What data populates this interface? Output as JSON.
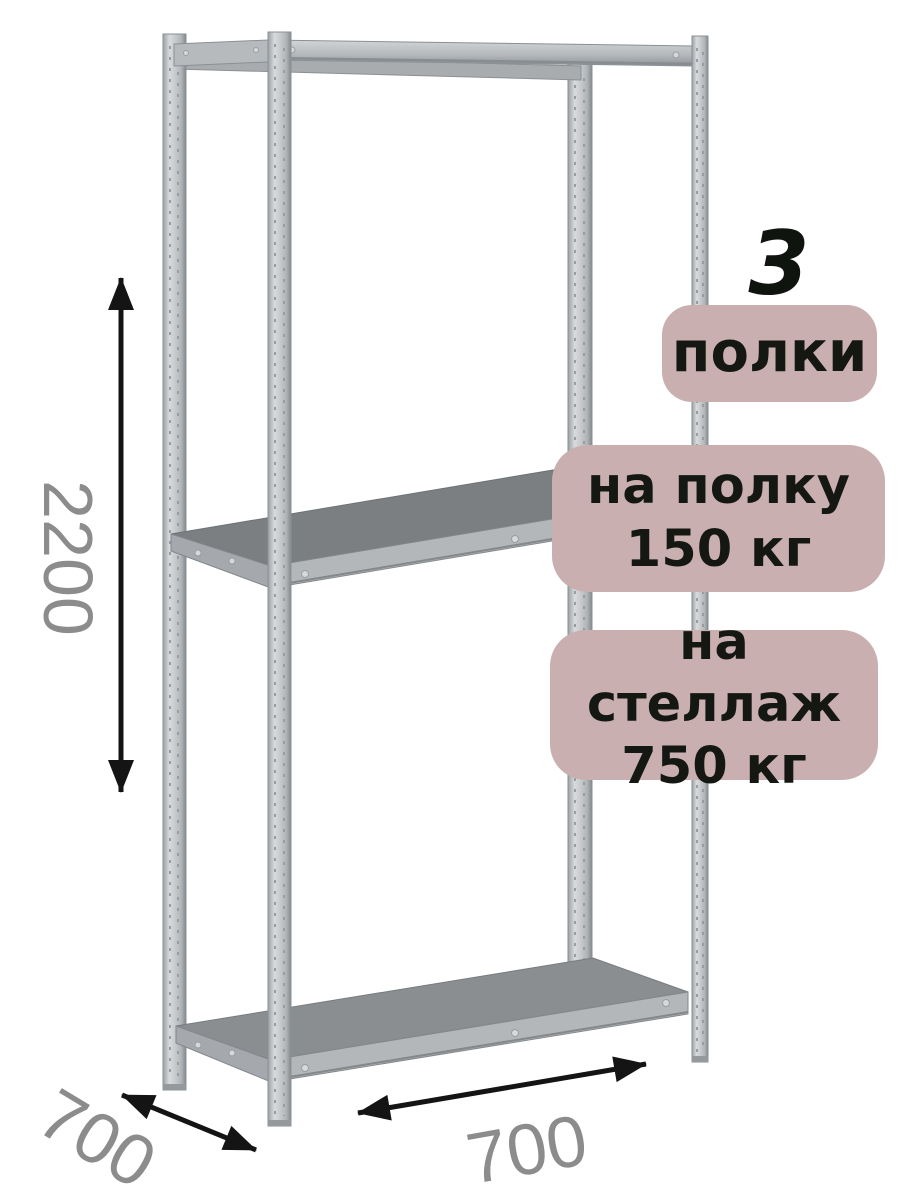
{
  "illustration": {
    "description": "metal shelving rack with three shelves, four perforated posts, isometric product view",
    "shelf_count": 3
  },
  "dimensions": {
    "height": "2200",
    "depth": "700",
    "width": "700"
  },
  "badges": {
    "shelf_count": {
      "number": "3",
      "label": "полки"
    },
    "shelf_load": {
      "line1": "на полку",
      "line2": "150 кг"
    },
    "rack_load": {
      "line1": "на стеллаж",
      "line2": "750 кг"
    }
  },
  "colors": {
    "background": "#ffffff",
    "badge_background": "#c9afb0",
    "badge_text": "#151812",
    "dimension_text": "#8c8c8c",
    "arrow": "#141414",
    "metal_light": "#d8dadc",
    "metal_dark": "#83888c",
    "shelf_surface": "#8a8e91"
  }
}
